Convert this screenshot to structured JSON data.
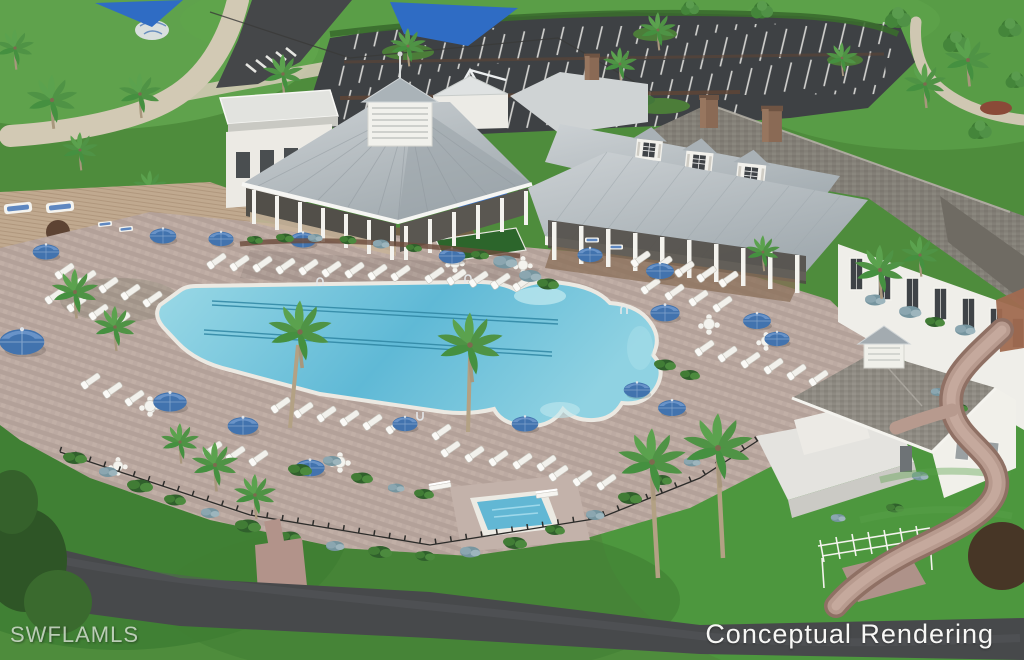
{
  "overlay": {
    "watermark": "SWFLAMLS",
    "caption": "Conceptual Rendering"
  },
  "palette": {
    "grass": "#4e8c3c",
    "grass_light": "#66ab52",
    "grass_dark": "#3b7a31",
    "asphalt_parking": "#3e4144",
    "road": "#47494b",
    "pool_water": "#5fb9d6",
    "pool_water_light": "#9bd9e6",
    "deck_paver": "#b9a8a0",
    "wood_deck": "#c2ab92",
    "brick_path": "#b5978c",
    "roof_metal": "#b6bec2",
    "roof_shingle": "#8e8a82",
    "wall_white": "#f2f1ec",
    "umbrella_blue": "#4273ae",
    "shade_sail_blue": "#2f6cc4",
    "shrub_green": "#3c7231",
    "shrub_silver": "#8ba6b0",
    "palm_frond": "#4f9345",
    "putting_green": "#2c652b",
    "mulch": "#6b4b3b"
  },
  "features": [
    "parking lot with striped spaces",
    "entry road with crosswalk",
    "playground with blue shade sails",
    "clubhouse with cupola pavilion",
    "covered lanai with columns and dormers",
    "resort swimming pool with lap lanes",
    "spa with bench seating",
    "paver pool deck with chaise lounges",
    "blue market umbrellas",
    "restroom pool house with cupola",
    "pergola with bench",
    "community road"
  ]
}
